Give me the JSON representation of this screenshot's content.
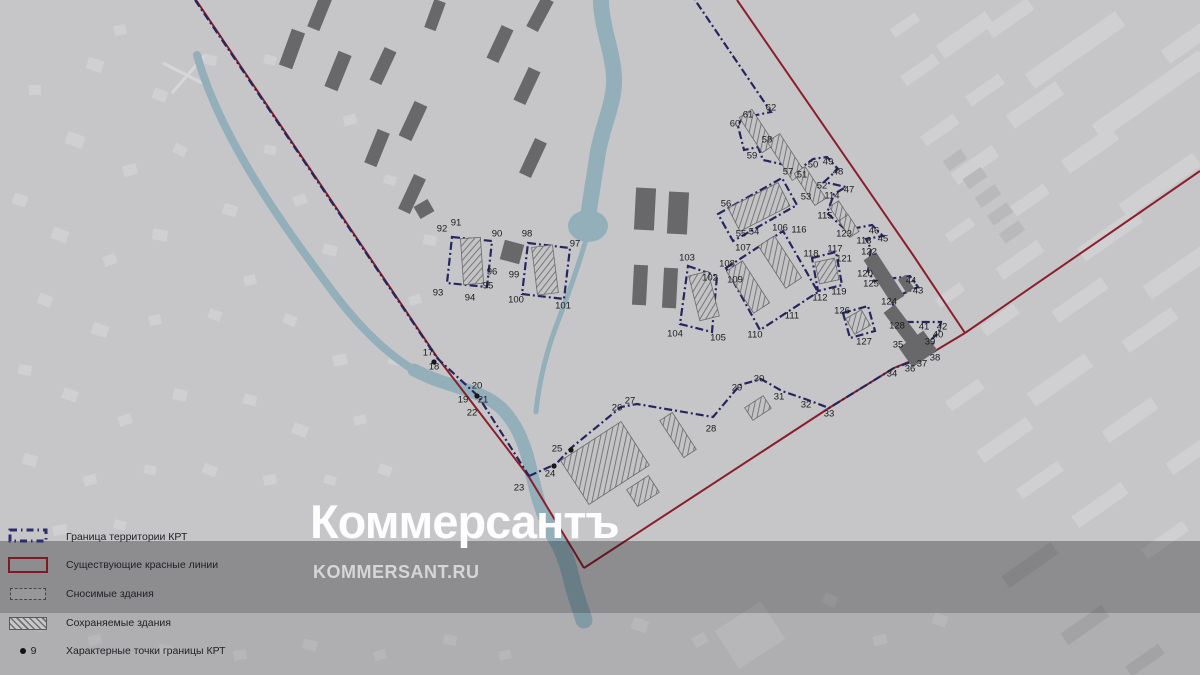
{
  "watermark": {
    "logo": "Коммерсантъ",
    "site": "KOMMERSANT.RU"
  },
  "legend": {
    "items": [
      {
        "key": "krt-boundary",
        "label": "Граница территории КРТ",
        "type": "dashdot-rect",
        "color": "#2c2c6e"
      },
      {
        "key": "red-lines",
        "label": "Существующие красные линии",
        "type": "outline-rect",
        "color": "#7c1b26"
      },
      {
        "key": "demolished",
        "label": "Сносимые здания",
        "type": "filled-rect",
        "color": "#97979a"
      },
      {
        "key": "preserved",
        "label": "Сохраняемые здания",
        "type": "hatched-rect",
        "color": "#707072"
      },
      {
        "key": "boundary-points",
        "label": "Характерные точки границы КРТ",
        "type": "dot",
        "sample": "9"
      }
    ]
  },
  "map": {
    "colors": {
      "background": "#c6c6c9",
      "bg_building": "#d0d0d3",
      "bg_building_dark": "#b9b9bc",
      "river": "#93afba",
      "navy": "#26265f",
      "red": "#8a1f2b",
      "demolished": "#68686a",
      "hatch": "#6f6f71",
      "label": "#1b1b1d",
      "road": "#d6d6d8"
    },
    "points": [
      [
        17,
        428,
        352
      ],
      [
        18,
        434,
        366
      ],
      [
        19,
        463,
        399
      ],
      [
        20,
        477,
        385
      ],
      [
        21,
        483,
        399
      ],
      [
        22,
        472,
        412
      ],
      [
        23,
        519,
        487
      ],
      [
        24,
        550,
        473
      ],
      [
        25,
        557,
        448
      ],
      [
        26,
        617,
        407
      ],
      [
        27,
        630,
        400
      ],
      [
        28,
        711,
        428
      ],
      [
        29,
        737,
        387
      ],
      [
        30,
        759,
        378
      ],
      [
        31,
        779,
        396
      ],
      [
        32,
        806,
        404
      ],
      [
        33,
        829,
        413
      ],
      [
        34,
        892,
        373
      ],
      [
        35,
        898,
        344
      ],
      [
        36,
        910,
        368
      ],
      [
        37,
        922,
        363
      ],
      [
        38,
        935,
        357
      ],
      [
        39,
        930,
        341
      ],
      [
        40,
        938,
        334
      ],
      [
        41,
        924,
        326
      ],
      [
        42,
        942,
        326
      ],
      [
        43,
        918,
        290
      ],
      [
        44,
        911,
        280
      ],
      [
        45,
        883,
        238
      ],
      [
        46,
        874,
        230
      ],
      [
        47,
        849,
        189
      ],
      [
        48,
        838,
        171
      ],
      [
        49,
        828,
        161
      ],
      [
        50,
        813,
        164
      ],
      [
        51,
        802,
        174
      ],
      [
        52,
        822,
        185
      ],
      [
        53,
        806,
        196
      ],
      [
        54,
        754,
        231
      ],
      [
        55,
        741,
        233
      ],
      [
        56,
        726,
        203
      ],
      [
        57,
        788,
        171
      ],
      [
        58,
        767,
        139
      ],
      [
        59,
        752,
        155
      ],
      [
        60,
        735,
        123
      ],
      [
        61,
        748,
        114
      ],
      [
        62,
        771,
        107
      ],
      [
        90,
        497,
        233
      ],
      [
        91,
        456,
        222
      ],
      [
        92,
        442,
        228
      ],
      [
        93,
        438,
        292
      ],
      [
        94,
        470,
        297
      ],
      [
        95,
        488,
        285
      ],
      [
        96,
        492,
        271
      ],
      [
        97,
        575,
        243
      ],
      [
        98,
        527,
        233
      ],
      [
        99,
        514,
        274
      ],
      [
        100,
        516,
        299
      ],
      [
        101,
        563,
        305
      ],
      [
        102,
        710,
        277
      ],
      [
        103,
        687,
        257
      ],
      [
        104,
        675,
        333
      ],
      [
        105,
        718,
        337
      ],
      [
        106,
        780,
        227
      ],
      [
        107,
        743,
        247
      ],
      [
        108,
        727,
        263
      ],
      [
        109,
        735,
        279
      ],
      [
        110,
        755,
        334
      ],
      [
        111,
        792,
        315
      ],
      [
        112,
        820,
        297
      ],
      [
        113,
        864,
        240
      ],
      [
        114,
        832,
        195
      ],
      [
        115,
        825,
        215
      ],
      [
        116,
        799,
        229
      ],
      [
        117,
        835,
        248
      ],
      [
        118,
        811,
        253
      ],
      [
        119,
        839,
        291
      ],
      [
        120,
        865,
        273
      ],
      [
        121,
        844,
        258
      ],
      [
        122,
        869,
        251
      ],
      [
        123,
        844,
        233
      ],
      [
        124,
        889,
        301
      ],
      [
        125,
        871,
        283
      ],
      [
        126,
        842,
        310
      ],
      [
        127,
        864,
        341
      ],
      [
        128,
        897,
        325
      ]
    ],
    "vertex_dots": [
      [
        434,
        362
      ],
      [
        477,
        396
      ],
      [
        554,
        466
      ],
      [
        571,
        450
      ]
    ],
    "boundary_paths": [
      "M 195,0 L 437,358 L 478,396 L 529,476",
      "M 529,476 L 556,464 L 571,448 L 621,407 L 637,404 L 713,417 L 740,385 L 761,379 L 782,391 L 808,400 L 829,408 L 894,368 L 911,362 L 924,357 L 935,351 L 932,339 L 939,332 L 941,322 L 923,322 L 899,322 L 891,299 L 918,287 L 910,276 L 874,281 L 868,271 L 871,249 L 866,239 L 883,236 L 872,225 L 846,230 L 827,213 L 834,194 L 846,187 L 824,182 L 838,169 L 827,157 L 813,159 L 801,168 L 790,166 L 763,160 L 758,147 L 744,150 L 738,126 L 742,118 L 771,112 L 695,0",
      "M 718,214 L 782,178 L 797,205 L 733,241 Z",
      "M 726,268 L 783,231 L 818,292 L 760,330 Z",
      "M 688,266 L 717,276 L 712,332 L 680,324 Z",
      "M 812,258 L 836,252 L 842,285 L 818,291 Z",
      "M 843,313 L 868,306 L 875,331 L 850,338 Z",
      "M 452,237 L 492,241 L 487,287 L 447,283 Z",
      "M 528,243 L 570,248 L 564,299 L 522,294 Z"
    ],
    "red_paths": [
      "M 737,0 L 913,255 L 965,333",
      "M 965,333 L 1200,171",
      "M 584,568 L 829,408 L 894,368 L 935,351 L 965,333",
      "M 196,0 L 437,357 L 529,477 L 584,568"
    ],
    "rivers": [
      {
        "d": "M 601,-5 C 600,25 613,50 614,78 C 615,104 601,128 597,158 C 593,186 589,205 587,228",
        "w": 16
      },
      {
        "d": "M 587,236 C 578,268 566,300 554,332 C 544,360 538,390 536,412",
        "w": 5
      },
      {
        "d": "M 197,55 C 208,95 228,135 252,175 C 278,218 306,256 336,296 C 362,330 390,356 414,370",
        "w": 8
      },
      {
        "d": "M 414,370 C 448,388 478,388 500,407 C 515,421 524,442 529,462 C 534,483 538,505 548,525",
        "w": 13
      },
      {
        "d": "M 548,525 C 560,543 566,556 571,577 C 576,598 581,610 584,620",
        "w": 17
      }
    ],
    "pond": {
      "cx": 588,
      "cy": 226,
      "rx": 20,
      "ry": 16
    },
    "roads": [
      "M 163,63 L 212,88",
      "M 205,55 L 172,93"
    ],
    "demolished": [
      [
        320,
        12,
        13,
        36,
        22
      ],
      [
        292,
        49,
        14,
        38,
        20
      ],
      [
        338,
        71,
        14,
        38,
        22
      ],
      [
        383,
        66,
        13,
        36,
        25
      ],
      [
        435,
        15,
        12,
        30,
        20
      ],
      [
        413,
        121,
        14,
        38,
        25
      ],
      [
        377,
        148,
        13,
        36,
        22
      ],
      [
        412,
        194,
        13,
        38,
        25
      ],
      [
        500,
        44,
        13,
        36,
        25
      ],
      [
        540,
        14,
        13,
        34,
        28
      ],
      [
        527,
        86,
        13,
        36,
        25
      ],
      [
        533,
        158,
        13,
        38,
        25
      ],
      [
        645,
        209,
        20,
        42,
        3
      ],
      [
        678,
        213,
        20,
        42,
        3
      ],
      [
        640,
        285,
        14,
        40,
        3
      ],
      [
        670,
        288,
        14,
        40,
        3
      ],
      [
        512,
        252,
        20,
        20,
        15
      ],
      [
        424,
        209,
        16,
        14,
        -30
      ],
      [
        884,
        278,
        15,
        52,
        -33
      ],
      [
        903,
        327,
        14,
        46,
        -37
      ],
      [
        918,
        349,
        30,
        24,
        -35
      ],
      [
        906,
        284,
        9,
        16,
        -33
      ]
    ],
    "preserved": [
      [
        472,
        261,
        20,
        46,
        -4
      ],
      [
        545,
        270,
        21,
        48,
        -7
      ],
      [
        704,
        296,
        20,
        46,
        -14
      ],
      [
        748,
        287,
        19,
        50,
        -33
      ],
      [
        780,
        262,
        19,
        50,
        -33
      ],
      [
        759,
        207,
        56,
        26,
        -27
      ],
      [
        757,
        131,
        15,
        42,
        -33
      ],
      [
        786,
        157,
        15,
        46,
        -33
      ],
      [
        810,
        186,
        13,
        38,
        -33
      ],
      [
        840,
        213,
        11,
        22,
        -33
      ],
      [
        849,
        226,
        11,
        20,
        -33
      ],
      [
        827,
        271,
        20,
        22,
        -12
      ],
      [
        858,
        322,
        18,
        18,
        -30
      ],
      [
        605,
        463,
        72,
        52,
        -33
      ],
      [
        643,
        491,
        26,
        20,
        -33
      ],
      [
        678,
        435,
        15,
        44,
        -33
      ],
      [
        758,
        408,
        22,
        15,
        -33
      ]
    ],
    "bg_buildings": [
      [
        95,
        65,
        16,
        12,
        18
      ],
      [
        120,
        30,
        12,
        10,
        -10
      ],
      [
        160,
        95,
        14,
        11,
        20
      ],
      [
        210,
        60,
        13,
        10,
        15
      ],
      [
        75,
        140,
        18,
        13,
        20
      ],
      [
        130,
        170,
        14,
        11,
        -15
      ],
      [
        180,
        150,
        13,
        10,
        25
      ],
      [
        35,
        90,
        12,
        10,
        0
      ],
      [
        20,
        200,
        14,
        11,
        15
      ],
      [
        60,
        235,
        16,
        12,
        20
      ],
      [
        110,
        260,
        13,
        10,
        -20
      ],
      [
        160,
        235,
        15,
        11,
        10
      ],
      [
        45,
        300,
        14,
        11,
        22
      ],
      [
        100,
        330,
        16,
        12,
        18
      ],
      [
        155,
        320,
        12,
        10,
        -12
      ],
      [
        25,
        370,
        13,
        10,
        8
      ],
      [
        70,
        395,
        15,
        11,
        20
      ],
      [
        125,
        420,
        13,
        10,
        -18
      ],
      [
        180,
        395,
        14,
        11,
        12
      ],
      [
        215,
        315,
        13,
        10,
        20
      ],
      [
        250,
        280,
        12,
        10,
        -15
      ],
      [
        230,
        210,
        14,
        11,
        18
      ],
      [
        270,
        150,
        12,
        9,
        10
      ],
      [
        300,
        200,
        13,
        10,
        -20
      ],
      [
        330,
        250,
        14,
        10,
        15
      ],
      [
        290,
        320,
        13,
        10,
        22
      ],
      [
        340,
        360,
        14,
        11,
        -10
      ],
      [
        250,
        400,
        13,
        10,
        15
      ],
      [
        300,
        430,
        15,
        11,
        20
      ],
      [
        360,
        420,
        12,
        9,
        -14
      ],
      [
        395,
        360,
        13,
        10,
        12
      ],
      [
        30,
        460,
        14,
        11,
        18
      ],
      [
        90,
        480,
        13,
        10,
        -15
      ],
      [
        150,
        470,
        12,
        9,
        10
      ],
      [
        210,
        470,
        14,
        10,
        20
      ],
      [
        270,
        480,
        13,
        10,
        -12
      ],
      [
        330,
        480,
        12,
        9,
        15
      ],
      [
        385,
        470,
        13,
        10,
        18
      ],
      [
        60,
        530,
        14,
        10,
        -10
      ],
      [
        120,
        525,
        12,
        9,
        15
      ],
      [
        415,
        300,
        12,
        9,
        -18
      ],
      [
        430,
        240,
        13,
        10,
        12
      ],
      [
        390,
        180,
        12,
        9,
        18
      ],
      [
        350,
        120,
        13,
        10,
        -15
      ],
      [
        270,
        60,
        12,
        9,
        15
      ],
      [
        35,
        625,
        15,
        11,
        12
      ],
      [
        95,
        640,
        13,
        10,
        -14
      ],
      [
        165,
        650,
        14,
        10,
        16
      ],
      [
        240,
        655,
        13,
        10,
        -10
      ],
      [
        310,
        645,
        14,
        10,
        14
      ],
      [
        380,
        655,
        12,
        9,
        -16
      ],
      [
        450,
        640,
        13,
        10,
        10
      ],
      [
        505,
        655,
        12,
        9,
        -12
      ],
      [
        640,
        625,
        16,
        12,
        20
      ],
      [
        700,
        640,
        14,
        11,
        -30
      ],
      [
        750,
        635,
        55,
        45,
        -33
      ],
      [
        830,
        600,
        14,
        11,
        25
      ],
      [
        880,
        640,
        13,
        10,
        -15
      ],
      [
        940,
        620,
        14,
        11,
        20
      ],
      [
        965,
        35,
        60,
        16,
        -35
      ],
      [
        1010,
        18,
        50,
        14,
        -35
      ],
      [
        1075,
        50,
        110,
        18,
        -35
      ],
      [
        1150,
        95,
        130,
        18,
        -35
      ],
      [
        1035,
        105,
        60,
        16,
        -35
      ],
      [
        985,
        90,
        40,
        12,
        -35
      ],
      [
        1090,
        150,
        60,
        16,
        -35
      ],
      [
        1160,
        185,
        90,
        16,
        -35
      ],
      [
        975,
        165,
        50,
        14,
        -35
      ],
      [
        1030,
        200,
        40,
        12,
        -35
      ],
      [
        1110,
        235,
        70,
        16,
        -35
      ],
      [
        1180,
        270,
        80,
        16,
        -35
      ],
      [
        1020,
        260,
        50,
        14,
        -35
      ],
      [
        1080,
        300,
        60,
        14,
        -35
      ],
      [
        1150,
        330,
        60,
        14,
        -35
      ],
      [
        920,
        70,
        40,
        12,
        -35
      ],
      [
        940,
        130,
        40,
        12,
        -35
      ],
      [
        1190,
        40,
        60,
        16,
        -35
      ],
      [
        960,
        230,
        30,
        10,
        -35
      ],
      [
        1000,
        320,
        40,
        12,
        -35
      ],
      [
        950,
        295,
        30,
        10,
        -35
      ],
      [
        905,
        25,
        30,
        10,
        -35
      ],
      [
        1060,
        380,
        70,
        16,
        -35
      ],
      [
        1130,
        420,
        60,
        14,
        -35
      ],
      [
        1190,
        455,
        50,
        14,
        -35
      ],
      [
        1005,
        440,
        60,
        14,
        -35
      ],
      [
        965,
        395,
        40,
        12,
        -35
      ],
      [
        1040,
        480,
        50,
        12,
        -35
      ],
      [
        1100,
        505,
        60,
        14,
        -35
      ],
      [
        1165,
        540,
        50,
        12,
        -35
      ]
    ],
    "bg_buildings_dark": [
      [
        955,
        160,
        22,
        12,
        -35
      ],
      [
        975,
        178,
        22,
        12,
        -35
      ],
      [
        988,
        196,
        24,
        12,
        -35
      ],
      [
        1000,
        214,
        24,
        12,
        -35
      ],
      [
        1012,
        232,
        24,
        12,
        -35
      ],
      [
        1030,
        565,
        60,
        14,
        -35
      ],
      [
        1085,
        625,
        50,
        14,
        -35
      ],
      [
        1145,
        660,
        40,
        12,
        -35
      ],
      [
        1230,
        585,
        60,
        14,
        -35
      ]
    ]
  }
}
